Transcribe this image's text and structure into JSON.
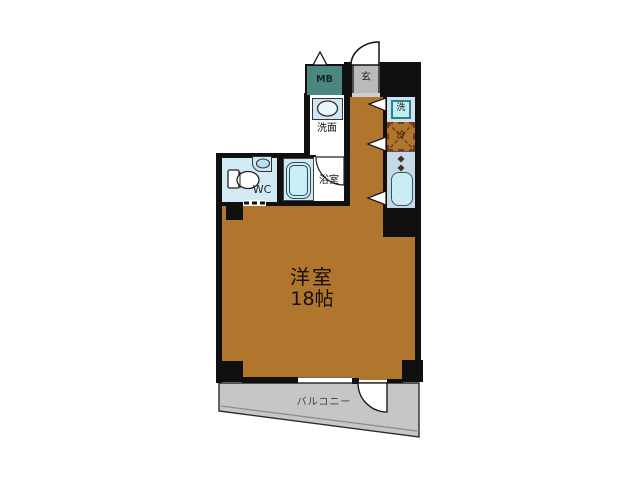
{
  "plan": {
    "type": "apartment-floor-plan",
    "rooms": {
      "main_room": {
        "name": "洋室",
        "size": "18帖"
      },
      "balcony": {
        "name": "バルコニー"
      },
      "toilet": {
        "name": "WC"
      },
      "washstand": {
        "name": "洗面"
      },
      "bathroom": {
        "name": "浴室"
      },
      "meter_box": {
        "name": "MB"
      },
      "entrance": {
        "name": "玄"
      },
      "washer_space": {
        "name": "洗"
      },
      "refrigerator_space": {
        "name": "冷"
      }
    },
    "colors": {
      "floor_brown": "#b0762e",
      "wall_black": "#101010",
      "meter_box_teal": "#4b8680",
      "entrance_gray": "#bababa",
      "balcony_gray": "#c6c6c6",
      "wet_area_blue": "#d2eaf4",
      "kitchen_counter_blue": "#c6d9e7",
      "fixture_cyan": "#c9eef6",
      "fridge_dash_brown": "#7c3a12",
      "background": "#ffffff"
    }
  }
}
